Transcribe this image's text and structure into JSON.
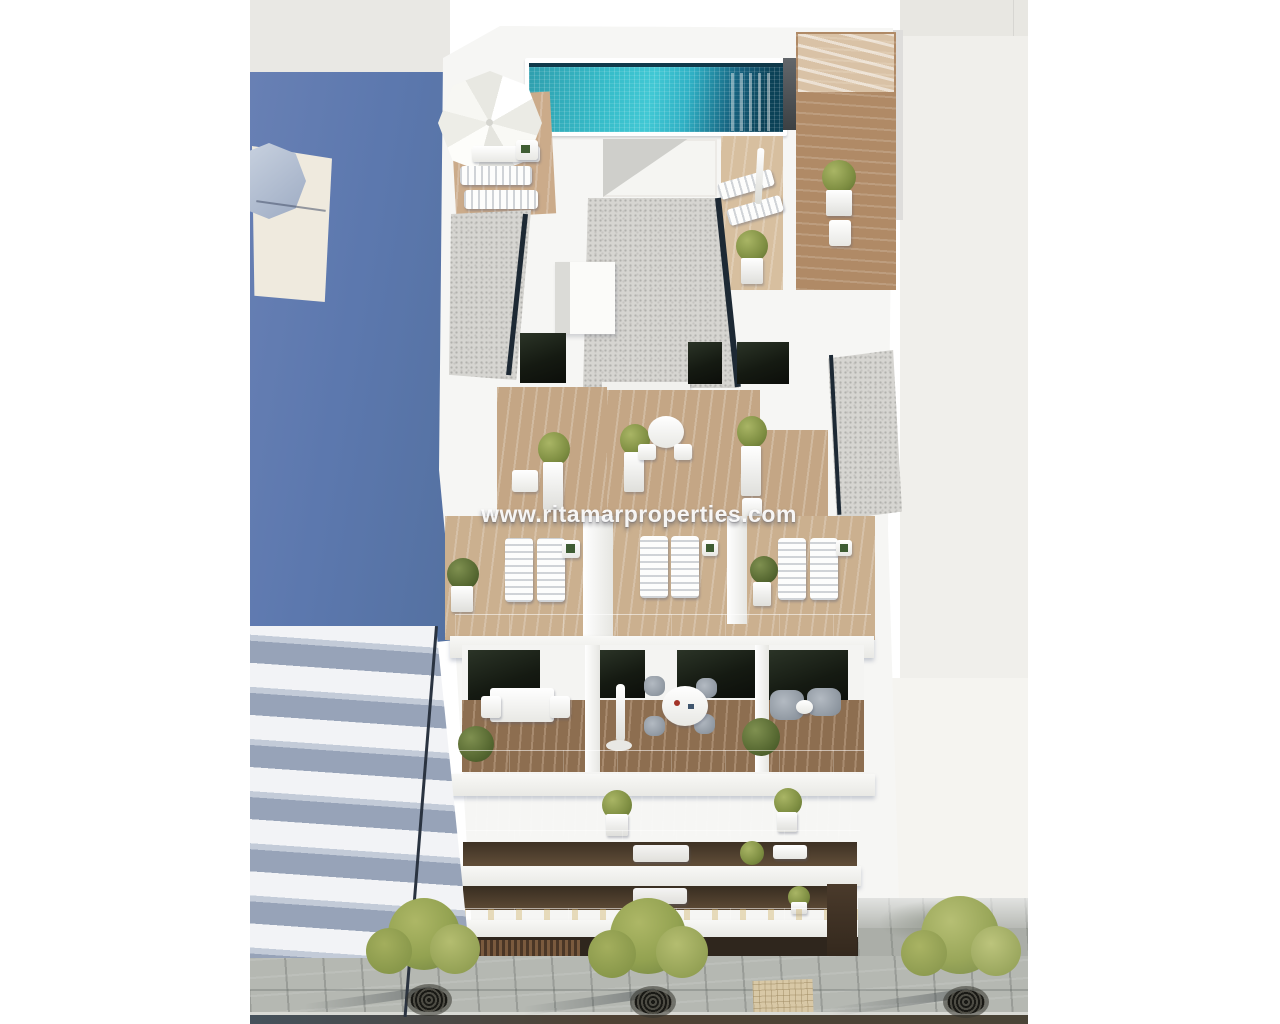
{
  "watermark": {
    "text": "www.ritamarproperties.com"
  },
  "palette": {
    "page_background": "#ffffff",
    "building_white": "#f6f6f4",
    "sky_shadow_blue": "#5c78ae",
    "pool_water": "#36bcc9",
    "pool_deep": "#0c4257",
    "deck_wood": "#c4a685",
    "balcony_wood": "#9b7a5a",
    "gravel_roof": "#d6d5d1",
    "neighbor_right_facade": "#f0efeb",
    "neighbor_left_slab": "#f2f3f6",
    "neighbor_left_shadow": "#97a3b8",
    "glass_dark": "#1c2418",
    "sidewalk_gray": "#b5b8b2",
    "street_asphalt": "#4a4437",
    "tree_foliage": "#93a251",
    "doormat_beige": "#d8c8a6"
  },
  "scene": {
    "description": "Aerial 3D rendering of a modern white apartment building",
    "elements": [
      "rooftop-pool",
      "rooftop-pool-deck",
      "rooftop-parasol",
      "rooftop-sun-loungers",
      "gravel-roof-sections",
      "penthouse-terraces",
      "terrace-plants",
      "terrace-dining-set",
      "solarium-sun-loungers",
      "glass-balustrades",
      "balcony-round-table",
      "balcony-armchairs",
      "balcony-closed-parasol",
      "lower-balconies",
      "ground-floor-recess",
      "sidewalk",
      "street-trees",
      "tree-grates",
      "doormat",
      "street-asphalt",
      "neighbor-building-left",
      "neighbor-building-right",
      "blue-shadow-backdrop",
      "neighbor-terrace-umbrella"
    ]
  }
}
